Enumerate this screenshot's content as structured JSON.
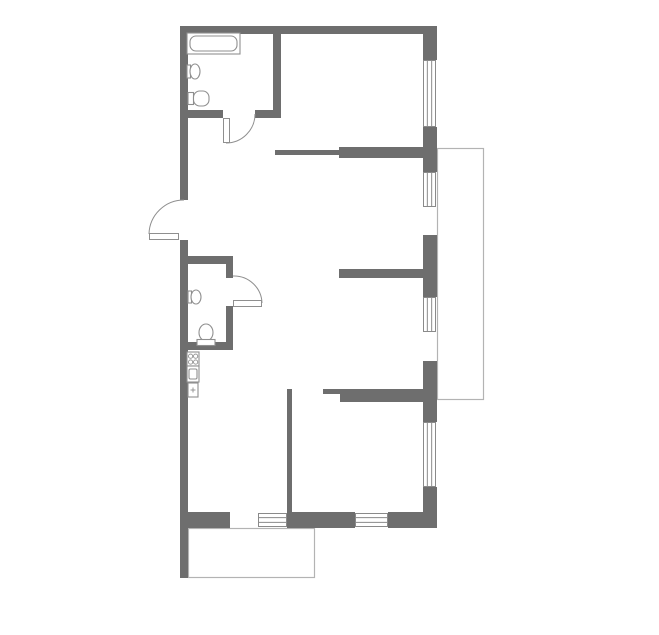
{
  "plan": {
    "canvas": {
      "width": 659,
      "height": 635,
      "background": "#ffffff"
    },
    "colors": {
      "wall": "#6e6e6e",
      "window_frame": "#8a8a8a",
      "window_fill": "#ffffff",
      "door_line": "#8f8f8f",
      "fixture_stroke": "#8f8f8f",
      "fixture_fill": "#ffffff",
      "balcony_line": "#b3b3b3"
    },
    "balconies": [
      {
        "name": "right-balcony-outline",
        "x": 437,
        "y": 148,
        "w": 46,
        "h": 251
      },
      {
        "name": "bottom-balcony-outline",
        "x": 188,
        "y": 528,
        "w": 126,
        "h": 49
      }
    ],
    "walls": [
      {
        "name": "top-exterior-wall",
        "x": 181,
        "y": 26,
        "w": 256,
        "h": 8
      },
      {
        "name": "left-exterior-wall-upper",
        "x": 180,
        "y": 26,
        "w": 8,
        "h": 174
      },
      {
        "name": "left-exterior-wall-lower",
        "x": 180,
        "y": 240,
        "w": 8,
        "h": 338
      },
      {
        "name": "right-exterior-wall-seg1",
        "x": 423,
        "y": 26,
        "w": 14,
        "h": 34
      },
      {
        "name": "right-exterior-wall-seg2",
        "x": 423,
        "y": 127,
        "w": 14,
        "h": 45
      },
      {
        "name": "right-exterior-wall-seg3",
        "x": 423,
        "y": 235,
        "w": 14,
        "h": 62
      },
      {
        "name": "right-exterior-wall-seg4",
        "x": 423,
        "y": 361,
        "w": 14,
        "h": 61
      },
      {
        "name": "right-exterior-wall-seg5",
        "x": 423,
        "y": 487,
        "w": 14,
        "h": 41
      },
      {
        "name": "bottom-wall-left-stub",
        "x": 188,
        "y": 512,
        "w": 42,
        "h": 16
      },
      {
        "name": "bottom-wall-middle",
        "x": 287,
        "y": 512,
        "w": 68,
        "h": 16
      },
      {
        "name": "bottom-wall-right",
        "x": 388,
        "y": 512,
        "w": 49,
        "h": 16
      },
      {
        "name": "bathroom-right-wall",
        "x": 273,
        "y": 34,
        "w": 8,
        "h": 84
      },
      {
        "name": "bathroom-bottom-wall-left",
        "x": 188,
        "y": 110,
        "w": 35,
        "h": 8
      },
      {
        "name": "bathroom-bottom-wall-right",
        "x": 255,
        "y": 110,
        "w": 26,
        "h": 8
      },
      {
        "name": "hall-top-thin-partition",
        "x": 275,
        "y": 150,
        "w": 64,
        "h": 5
      },
      {
        "name": "room1-bottom-wall",
        "x": 339,
        "y": 147,
        "w": 84,
        "h": 11
      },
      {
        "name": "room2-bottom-wall",
        "x": 339,
        "y": 269,
        "w": 84,
        "h": 9
      },
      {
        "name": "room3-bottom-wall",
        "x": 340,
        "y": 389,
        "w": 83,
        "h": 13
      },
      {
        "name": "room3-bottom-thin-notch",
        "x": 323,
        "y": 389,
        "w": 17,
        "h": 5
      },
      {
        "name": "kitchen-partition-wall",
        "x": 287,
        "y": 389,
        "w": 5,
        "h": 128
      },
      {
        "name": "wc-top-wall",
        "x": 188,
        "y": 256,
        "w": 45,
        "h": 8
      },
      {
        "name": "wc-right-wall-upper",
        "x": 226,
        "y": 264,
        "w": 7,
        "h": 14
      },
      {
        "name": "wc-right-wall-lower",
        "x": 226,
        "y": 306,
        "w": 7,
        "h": 36
      },
      {
        "name": "wc-bottom-wall",
        "x": 188,
        "y": 342,
        "w": 45,
        "h": 8
      }
    ],
    "windows": [
      {
        "name": "window-right-top",
        "x": 423,
        "y": 60,
        "w": 13,
        "h": 67,
        "orient": "v"
      },
      {
        "name": "window-right-mid-upper",
        "x": 423,
        "y": 172,
        "w": 13,
        "h": 35,
        "orient": "v"
      },
      {
        "name": "window-right-mid-lower",
        "x": 423,
        "y": 297,
        "w": 13,
        "h": 35,
        "orient": "v"
      },
      {
        "name": "window-right-bottom",
        "x": 423,
        "y": 422,
        "w": 13,
        "h": 65,
        "orient": "v"
      },
      {
        "name": "window-bottom-left",
        "x": 258,
        "y": 513,
        "w": 29,
        "h": 14,
        "orient": "h"
      },
      {
        "name": "window-bottom-right",
        "x": 355,
        "y": 513,
        "w": 33,
        "h": 14,
        "orient": "h"
      }
    ],
    "doors": [
      {
        "name": "entrance-door",
        "leaf": {
          "x": 149,
          "y": 233,
          "w": 30,
          "h": 7
        },
        "arc": "M 149 234 A 35 35 0 0 1 184 200"
      },
      {
        "name": "bathroom-door",
        "leaf": {
          "x": 223,
          "y": 118,
          "w": 7,
          "h": 25
        },
        "arc": "M 226 143 A 29 29 0 0 0 255 114"
      },
      {
        "name": "wc-door",
        "leaf": {
          "x": 233,
          "y": 300,
          "w": 29,
          "h": 7
        },
        "arc": "M 262 303 A 28 28 0 0 0 233 276"
      }
    ],
    "fixtures": [
      {
        "type": "bathtub",
        "name": "bathtub",
        "x": 187,
        "y": 33,
        "w": 53,
        "h": 21
      },
      {
        "type": "sink",
        "name": "bathroom-sink",
        "x": 187,
        "y": 63,
        "w": 13,
        "h": 17
      },
      {
        "type": "toilet-right",
        "name": "bathroom-toilet",
        "x": 188,
        "y": 91,
        "w": 21,
        "h": 15
      },
      {
        "type": "sink",
        "name": "wc-sink",
        "x": 188,
        "y": 289,
        "w": 13,
        "h": 16
      },
      {
        "type": "toilet-up",
        "name": "wc-toilet",
        "x": 197,
        "y": 323,
        "w": 18,
        "h": 23
      },
      {
        "type": "stove",
        "name": "stove-icon",
        "x": 187,
        "y": 352,
        "w": 12,
        "h": 14
      },
      {
        "type": "oven",
        "name": "oven-icon",
        "x": 187,
        "y": 366,
        "w": 12,
        "h": 16
      },
      {
        "type": "fridge",
        "name": "fridge-icon",
        "x": 188,
        "y": 383,
        "w": 10,
        "h": 14
      }
    ]
  }
}
